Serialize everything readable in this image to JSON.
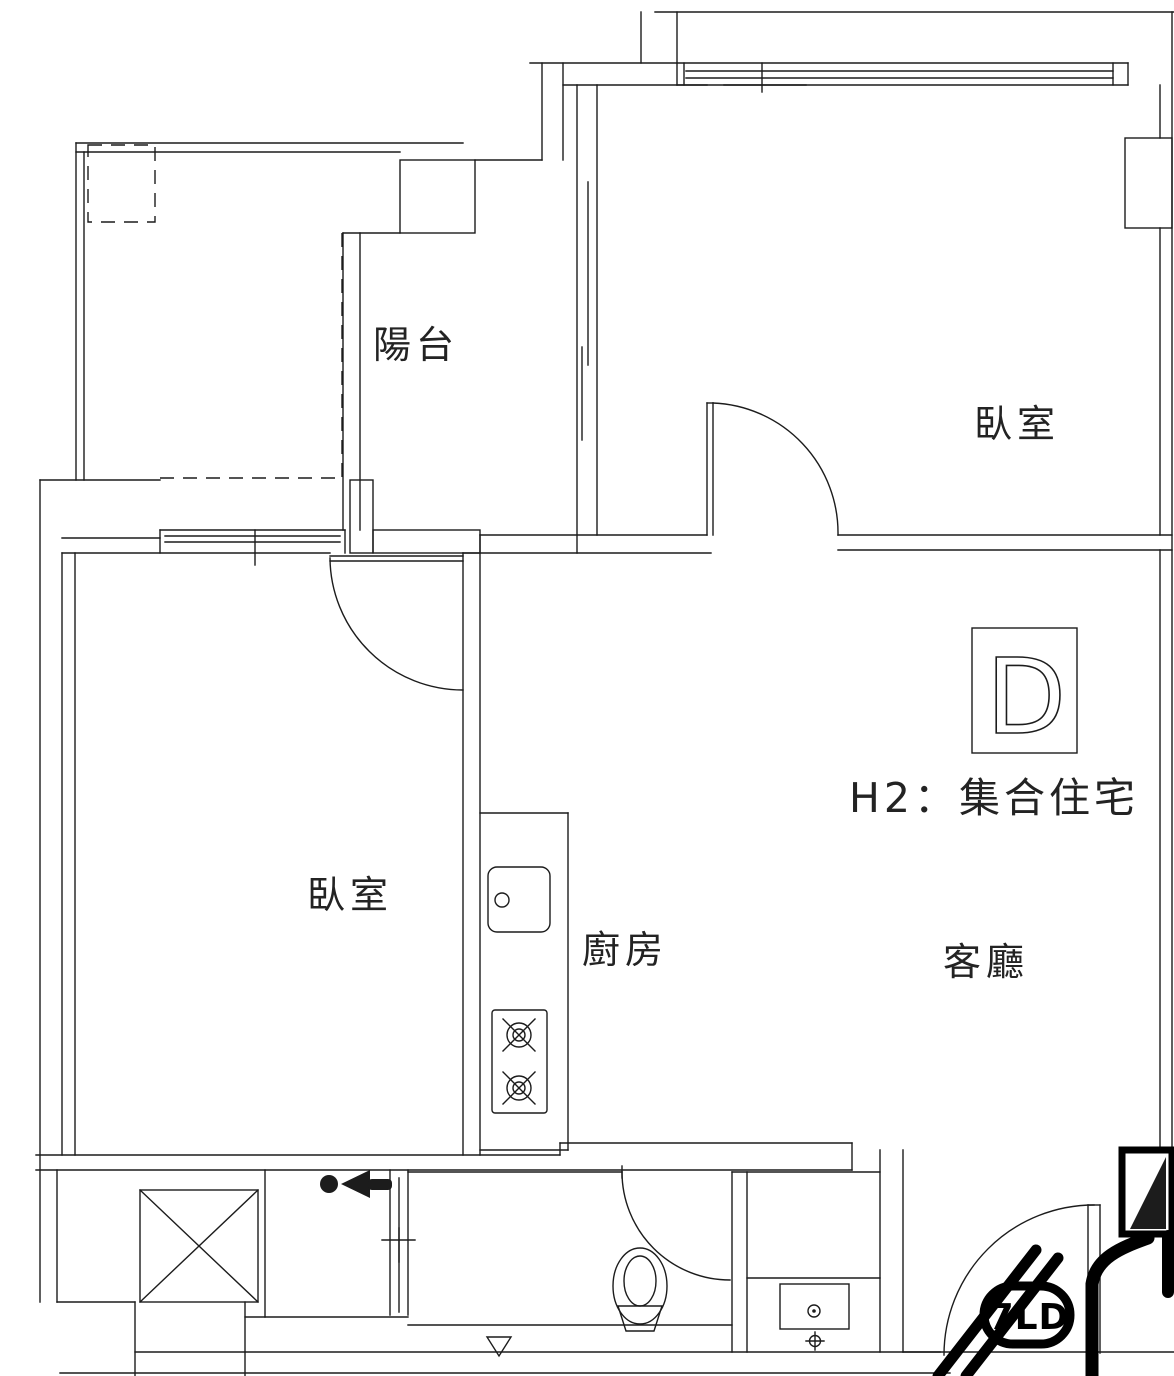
{
  "plan": {
    "type": "apartment-floor-plan",
    "unit": {
      "badge": "D",
      "label": "H2：集合住宅"
    },
    "rooms": {
      "balcony": "陽台",
      "bedroom_top_right": "臥室",
      "bedroom_left": "臥室",
      "kitchen": "廚房",
      "living_room": "客廳"
    },
    "annotation": {
      "scribble": "7LD"
    },
    "symbols": {
      "entry_marker": "person-arrow-left",
      "floor_drain": "crosshair-drain",
      "level_mark": "down-triangle",
      "shaft": "x-box",
      "fixtures": [
        "kitchen-sink",
        "two-burner-stove",
        "toilet",
        "vanity-basin"
      ]
    },
    "colors": {
      "line": "#1c1c1c",
      "background": "#ffffff",
      "marker_ink": "#000000"
    }
  }
}
